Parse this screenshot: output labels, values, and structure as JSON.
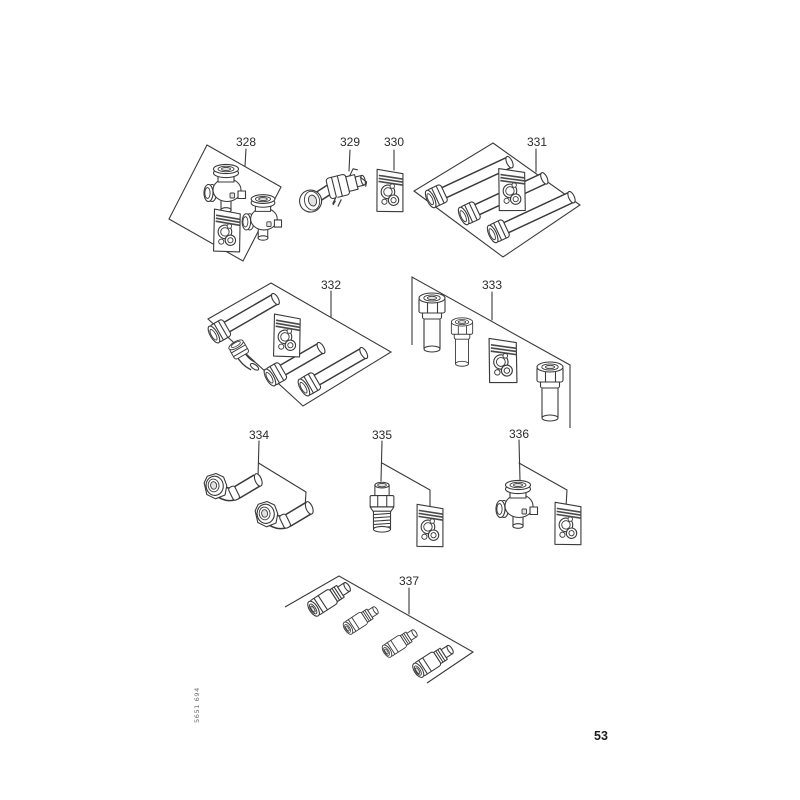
{
  "page": {
    "background": "#ffffff",
    "ink": "#3a3a3a",
    "doc_number": "5651 694",
    "page_number": "53"
  },
  "parts": [
    {
      "id": "328",
      "label": "328",
      "items": [
        "valve",
        "valve",
        "gasket-kit"
      ]
    },
    {
      "id": "329",
      "label": "329",
      "items": [
        "union-fitting"
      ]
    },
    {
      "id": "330",
      "label": "330",
      "items": [
        "gasket-kit"
      ]
    },
    {
      "id": "331",
      "label": "331",
      "items": [
        "pipe",
        "pipe",
        "pipe",
        "gasket-kit"
      ]
    },
    {
      "id": "332",
      "label": "332",
      "items": [
        "pipe",
        "pipe",
        "pipe",
        "elbow-nut",
        "gasket-kit"
      ]
    },
    {
      "id": "333",
      "label": "333",
      "items": [
        "adapter-bolt",
        "adapter-bolt",
        "adapter-bolt",
        "gasket-kit"
      ]
    },
    {
      "id": "334",
      "label": "334",
      "items": [
        "elbow-pipe",
        "elbow-pipe"
      ]
    },
    {
      "id": "335",
      "label": "335",
      "items": [
        "threaded-nipple",
        "gasket-kit"
      ]
    },
    {
      "id": "336",
      "label": "336",
      "items": [
        "valve",
        "gasket-kit"
      ]
    },
    {
      "id": "337",
      "label": "337",
      "items": [
        "coupler",
        "coupler",
        "coupler",
        "coupler"
      ]
    }
  ]
}
